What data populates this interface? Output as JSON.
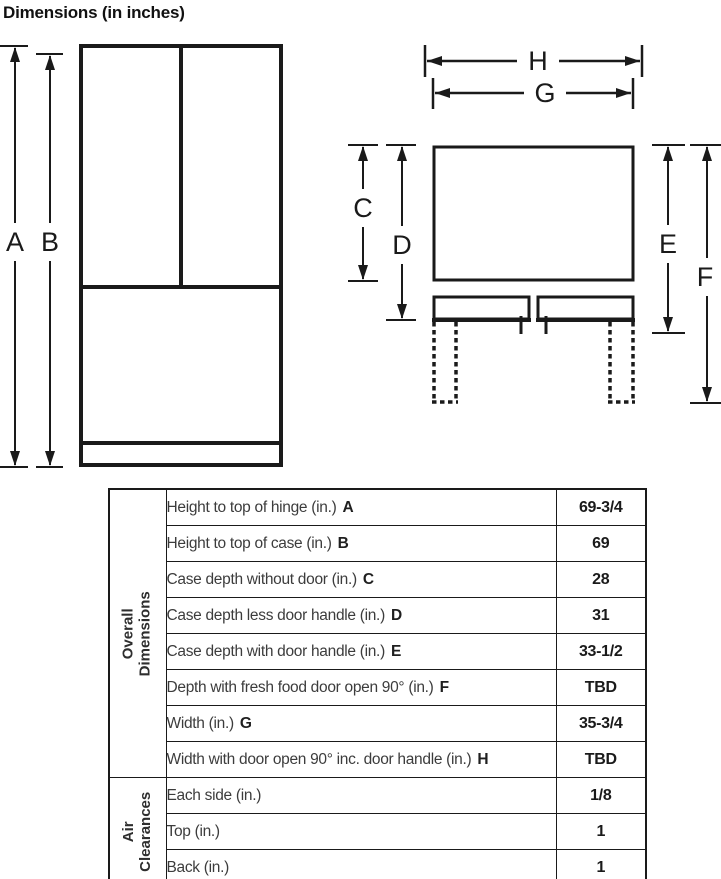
{
  "title": "Dimensions (in inches)",
  "diagram_labels": {
    "a": "A",
    "b": "B",
    "c": "C",
    "d": "D",
    "e": "E",
    "f": "F",
    "g": "G",
    "h": "H"
  },
  "table": {
    "groups": [
      {
        "line1": "Overall",
        "line2": "Dimensions"
      },
      {
        "line1": "Air",
        "line2": "Clearances"
      }
    ],
    "rows": [
      {
        "label": "Height to top of hinge (in.)",
        "letter": "A",
        "value": "69-3/4"
      },
      {
        "label": "Height to top of case (in.)",
        "letter": "B",
        "value": "69"
      },
      {
        "label": "Case depth without door (in.)",
        "letter": "C",
        "value": "28"
      },
      {
        "label": "Case depth less door handle (in.)",
        "letter": "D",
        "value": "31"
      },
      {
        "label": "Case depth with door handle (in.)",
        "letter": "E",
        "value": "33-1/2"
      },
      {
        "label": "Depth with fresh food door open 90° (in.)",
        "letter": "F",
        "value": "TBD"
      },
      {
        "label": "Width (in.)",
        "letter": "G",
        "value": "35-3/4"
      },
      {
        "label": "Width with door open 90° inc. door handle (in.)",
        "letter": "H",
        "value": "TBD"
      },
      {
        "label": "Each side (in.)",
        "letter": "",
        "value": "1/8"
      },
      {
        "label": "Top (in.)",
        "letter": "",
        "value": "1"
      },
      {
        "label": "Back (in.)",
        "letter": "",
        "value": "1"
      }
    ]
  },
  "colors": {
    "line": "#1a1a1a",
    "label_text": "#3c3c3c",
    "value_text": "#1a1a1a"
  }
}
